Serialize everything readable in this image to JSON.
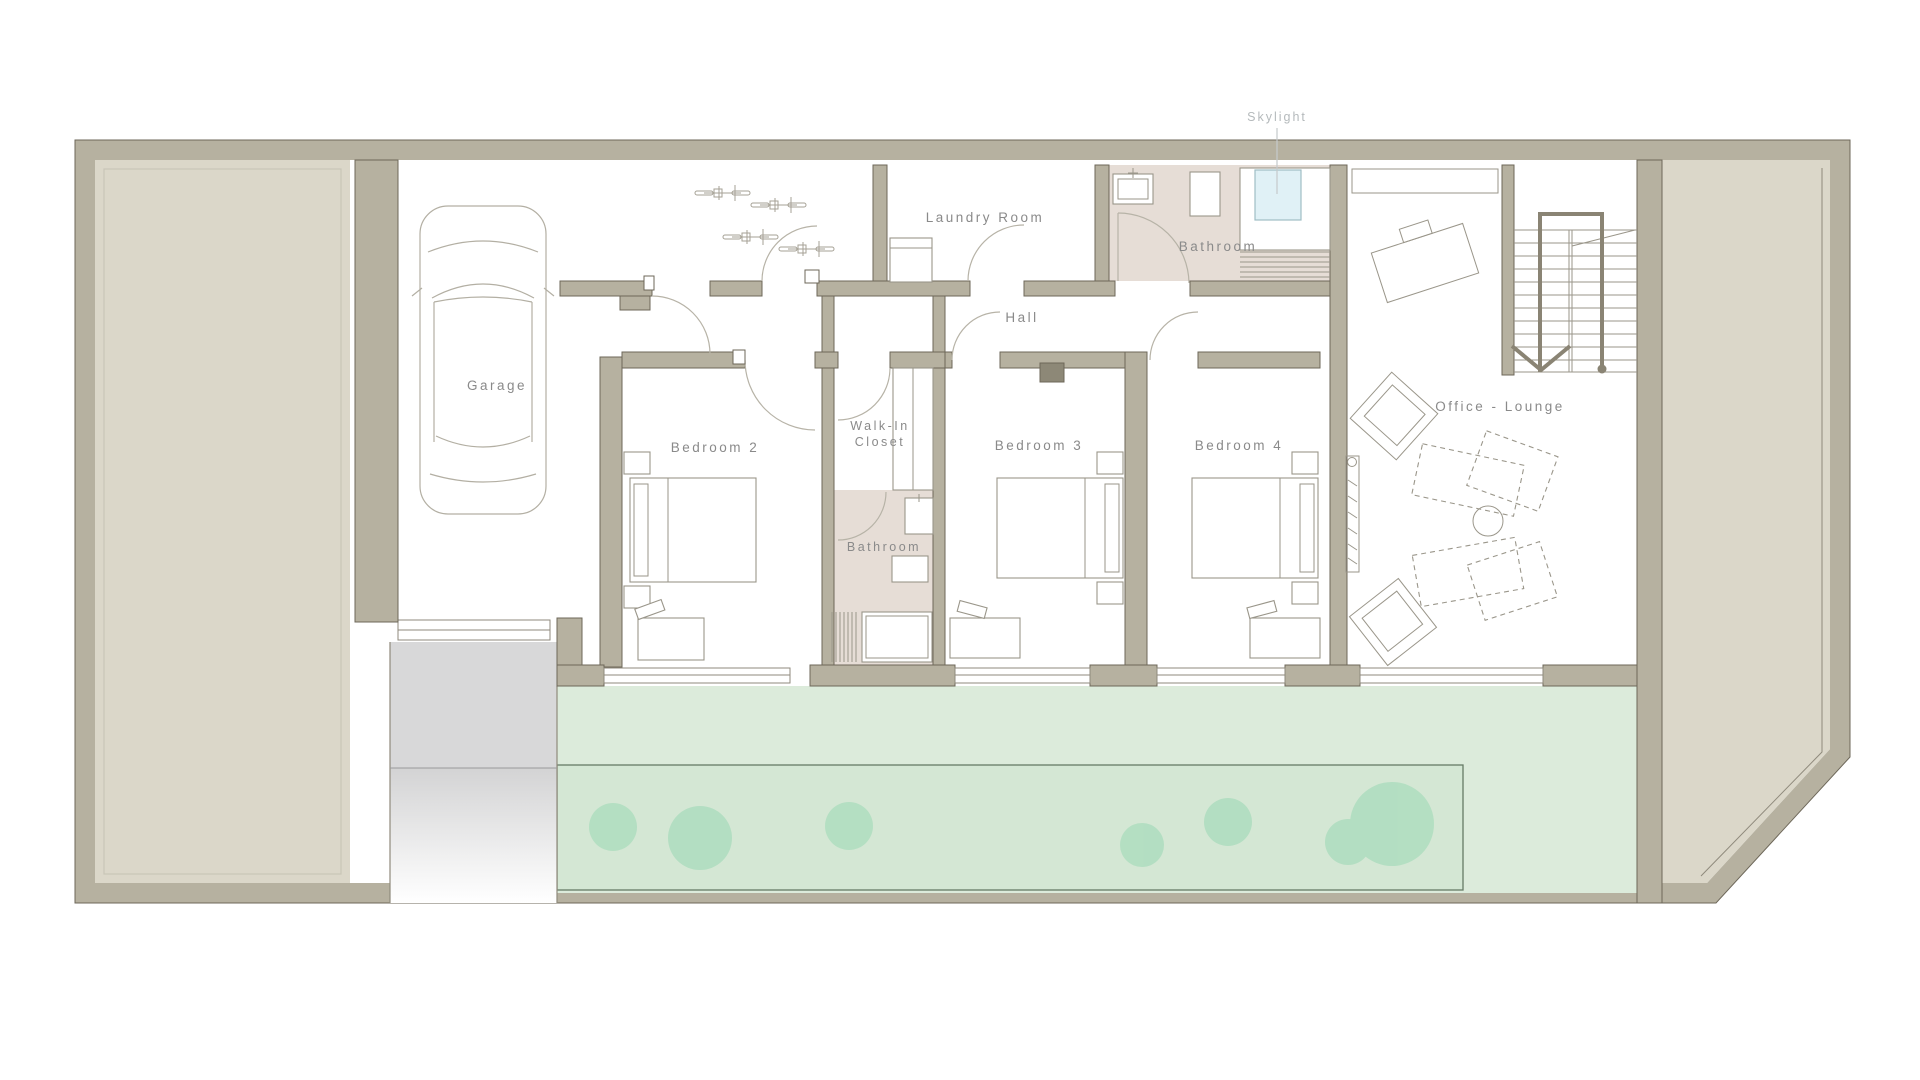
{
  "plan": {
    "type": "architectural-floor-plan",
    "labels": {
      "garage": "Garage",
      "laundry_room": "Laundry Room",
      "bathroom_top": "Bathroom",
      "skylight": "Skylight",
      "hall": "Hall",
      "bedroom_2": "Bedroom 2",
      "walk_in_closet_line1": "Walk-In",
      "walk_in_closet_line2": "Closet",
      "bathroom_middle": "Bathroom",
      "bedroom_3": "Bedroom 3",
      "bedroom_4": "Bedroom 4",
      "office_lounge": "Office - Lounge"
    },
    "colors": {
      "wall": "#b6b1a0",
      "wall_edge": "#6d6759",
      "yard": "#dbd7c9",
      "room": "#ffffff",
      "bathroom_floor": "#e6ddd6",
      "terrace_green": "#dcebdb",
      "garden_green": "#d4e7d4",
      "garden_edge": "#667a66",
      "tree_green": "#a9dcbc",
      "skylight_blue": "#e0f1f6",
      "driveway_grey": "#d8d8d9",
      "label_text": "#8a8a8a",
      "annotation_text": "#b5babc"
    }
  }
}
